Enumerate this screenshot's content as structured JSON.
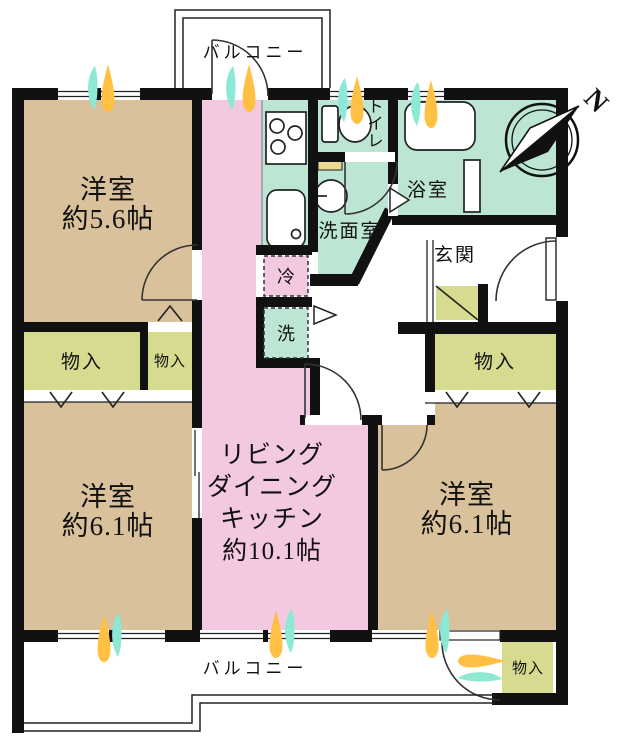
{
  "labels": {
    "balcony_top": "バルコニー",
    "balcony_bottom": "バルコニー",
    "north": "N",
    "room_nw_name": "洋室",
    "room_nw_size": "約5.6帖",
    "room_sw_name": "洋室",
    "room_sw_size": "約6.1帖",
    "room_se_name": "洋室",
    "room_se_size": "約6.1帖",
    "ldk_line1": "リビング",
    "ldk_line2": "ダイニング",
    "ldk_line3": "キッチン",
    "ldk_size": "約10.1帖",
    "toilet": "トイレ",
    "bathroom": "浴室",
    "washroom": "洗面室",
    "entrance": "玄関",
    "storage_w_large": "物入",
    "storage_w_small": "物入",
    "storage_e": "物入",
    "storage_balcony": "物入",
    "refrigerator": "冷",
    "washer": "洗"
  },
  "colors": {
    "wall": "#111111",
    "western_room": "#D9C19B",
    "ldk": "#F3C9E1",
    "wet_area": "#BCE6D3",
    "storage": "#D7DB90",
    "counter": "#EADC8F",
    "airflow_orange": "#FFC043",
    "airflow_cyan": "#8BE9D5"
  }
}
